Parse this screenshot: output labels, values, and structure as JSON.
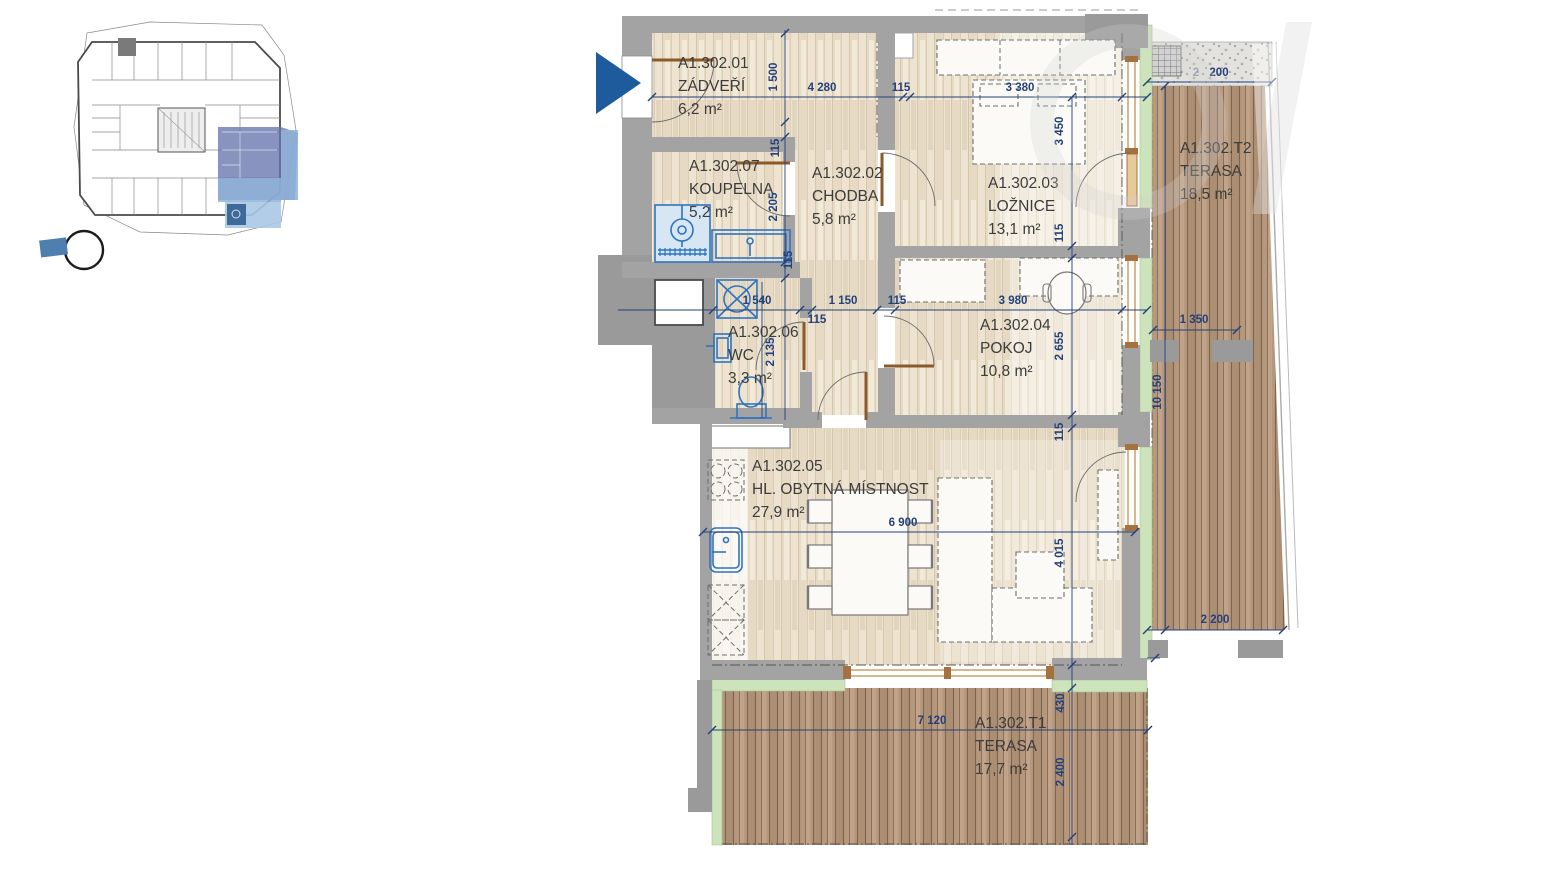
{
  "plan_sheet": {
    "unit": "A1.302",
    "rooms": [
      {
        "code": "A1.302.01",
        "name": "ZÁDVEŘÍ",
        "area": "6,2 m²"
      },
      {
        "code": "A1.302.02",
        "name": "CHODBA",
        "area": "5,8 m²"
      },
      {
        "code": "A1.302.03",
        "name": "LOŽNICE",
        "area": "13,1 m²"
      },
      {
        "code": "A1.302.04",
        "name": "POKOJ",
        "area": "10,8 m²"
      },
      {
        "code": "A1.302.05",
        "name": "HL. OBYTNÁ MÍSTNOST",
        "area": "27,9 m²"
      },
      {
        "code": "A1.302.06",
        "name": "WC",
        "area": "3,3 m²"
      },
      {
        "code": "A1.302.07",
        "name": "KOUPELNA",
        "area": "5,2 m²"
      },
      {
        "code": "A1.302.T1",
        "name": "TERASA",
        "area": "17,7 m²"
      },
      {
        "code": "A1.302.T2",
        "name": "TERASA",
        "area": "18,5 m²"
      }
    ],
    "dims": {
      "entry_depth": "1 500",
      "hall_width": "4 280",
      "wall_115_top": "115",
      "bedroom_width": "3 380",
      "bedroom_depth": "3 450",
      "wall_115_entry": "115",
      "bath_depth": "2 205",
      "wall_115_bath": "115",
      "wall_115_bed": "115",
      "wc_width": "1 540",
      "wall_115_wc": "115",
      "corridor_width": "1 150",
      "wall_115_corr": "115",
      "room_width": "3 980",
      "wc_depth": "2 135",
      "room_depth": "2 655",
      "wall_115_room": "115",
      "living_depth": "4 015",
      "living_width": "6 900",
      "t1_offset": "430",
      "t1_depth": "2 400",
      "t1_width": "7 120",
      "t2_width_faded": "2",
      "t2_width": "200",
      "t2_door": "1 350",
      "t2_length": "10 150",
      "t2_width_bottom": "2 200"
    },
    "colors": {
      "dimension_blue": "#24407a",
      "wall_gray": "#a3a3a3",
      "terrace_wood": "#b49478",
      "floor_wood": "#ece2cf",
      "fixture_blue": "#2f74c0",
      "green_edge": "#cde3bb",
      "entry_arrow_blue": "#1d5b9d",
      "keyplan_highlight": "#6874ad"
    }
  }
}
